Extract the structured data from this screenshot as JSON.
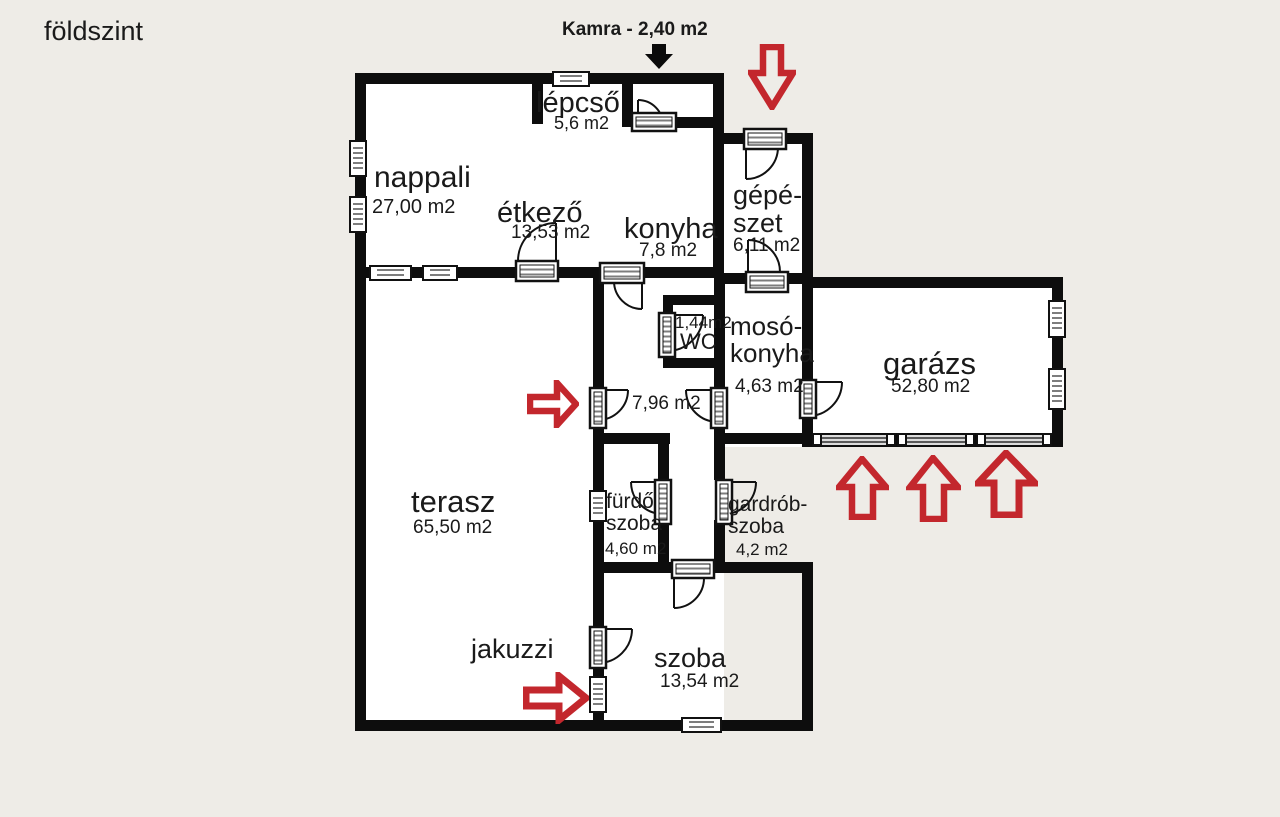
{
  "title": "földszint",
  "annotations": {
    "kamra_note": "Kamra - 2,40 m2"
  },
  "rooms": {
    "lepcso": {
      "name": "lépcső",
      "area": "5,6 m2"
    },
    "nappali": {
      "name": "nappali",
      "area": "27,00 m2"
    },
    "etkezo": {
      "name": "étkező",
      "area": "13,53 m2"
    },
    "konyha": {
      "name": "konyha",
      "area": "7,8 m2"
    },
    "gepeszet": {
      "name_line1": "gépé-",
      "name_line2": "szet",
      "area": "6,11 m2"
    },
    "wc": {
      "name": "WC",
      "area": "1,44m2"
    },
    "mosokonyha": {
      "name_line1": "mosó-",
      "name_line2": "konyha",
      "area": "4,63 m2"
    },
    "garazs": {
      "name": "garázs",
      "area": "52,80 m2"
    },
    "kozlekedo": {
      "area": "7,96 m2"
    },
    "terasz": {
      "name": "terasz",
      "area": "65,50 m2"
    },
    "furdoszoba": {
      "name_line1": "fürdő",
      "name_line2": "szoba",
      "area": "4,60 m2"
    },
    "gardrobszoba": {
      "name_line1": "gardrób-",
      "name_line2": "szoba",
      "area": "4,2 m2"
    },
    "jakuzzi": {
      "name": "jakuzzi"
    },
    "szoba": {
      "name": "szoba",
      "area": "13,54 m2"
    }
  },
  "colors": {
    "background": "#eeece7",
    "room_fill": "#ffffff",
    "wall": "#0d0d0d",
    "arrow_red": "#c3272d",
    "arrow_black": "#0a0a0a",
    "text": "#1a1a1a"
  }
}
